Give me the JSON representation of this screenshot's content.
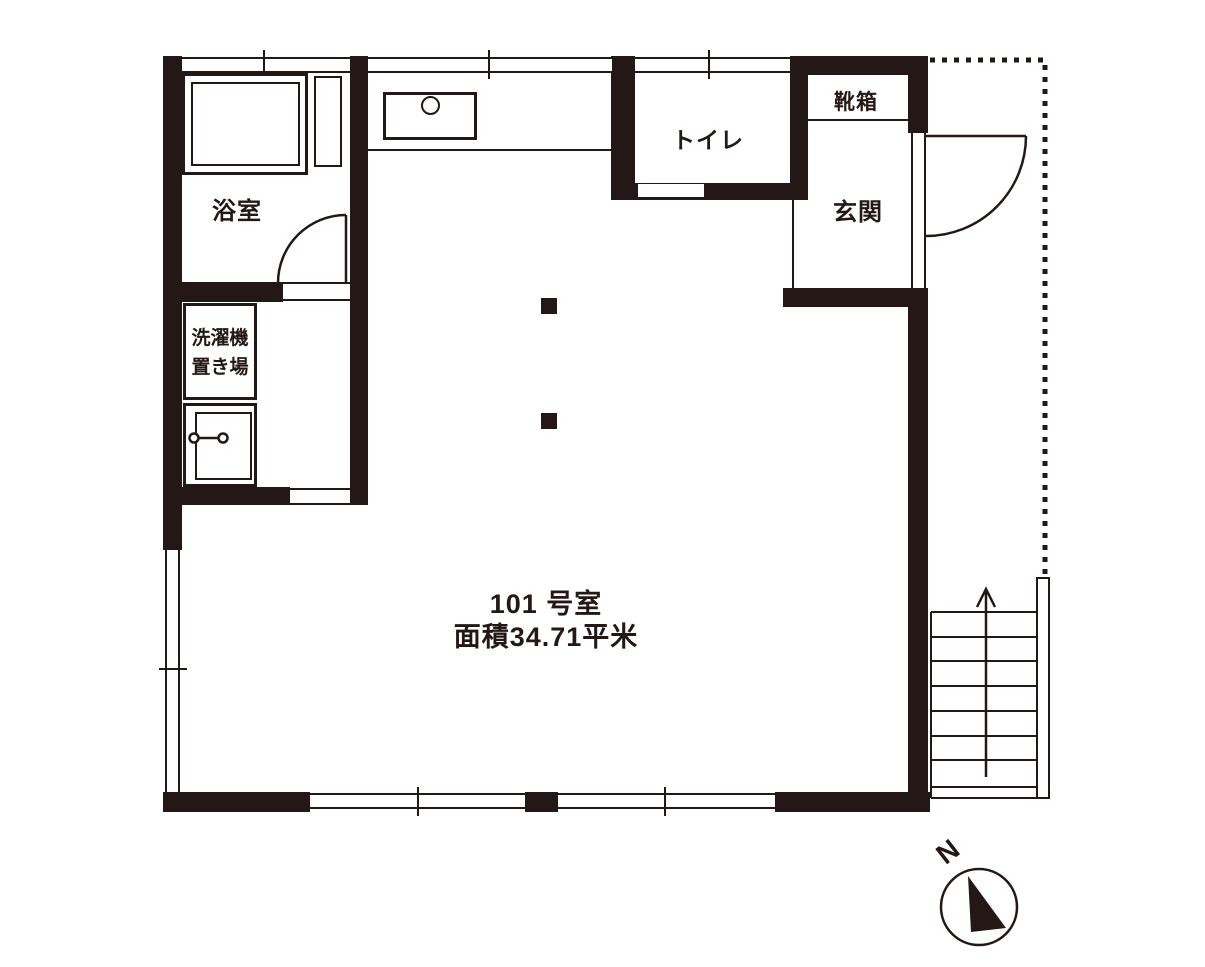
{
  "floor_plan": {
    "title_line1": "101 号室",
    "title_line2": "面積34.71平米",
    "labels": {
      "bathroom": "浴室",
      "laundry_line1": "洗濯機",
      "laundry_line2": "置き場",
      "toilet": "トイレ",
      "shoe_cabinet": "靴箱",
      "entrance": "玄関",
      "north": "N"
    },
    "colors": {
      "wall": "#231815",
      "background": "#ffffff"
    }
  }
}
